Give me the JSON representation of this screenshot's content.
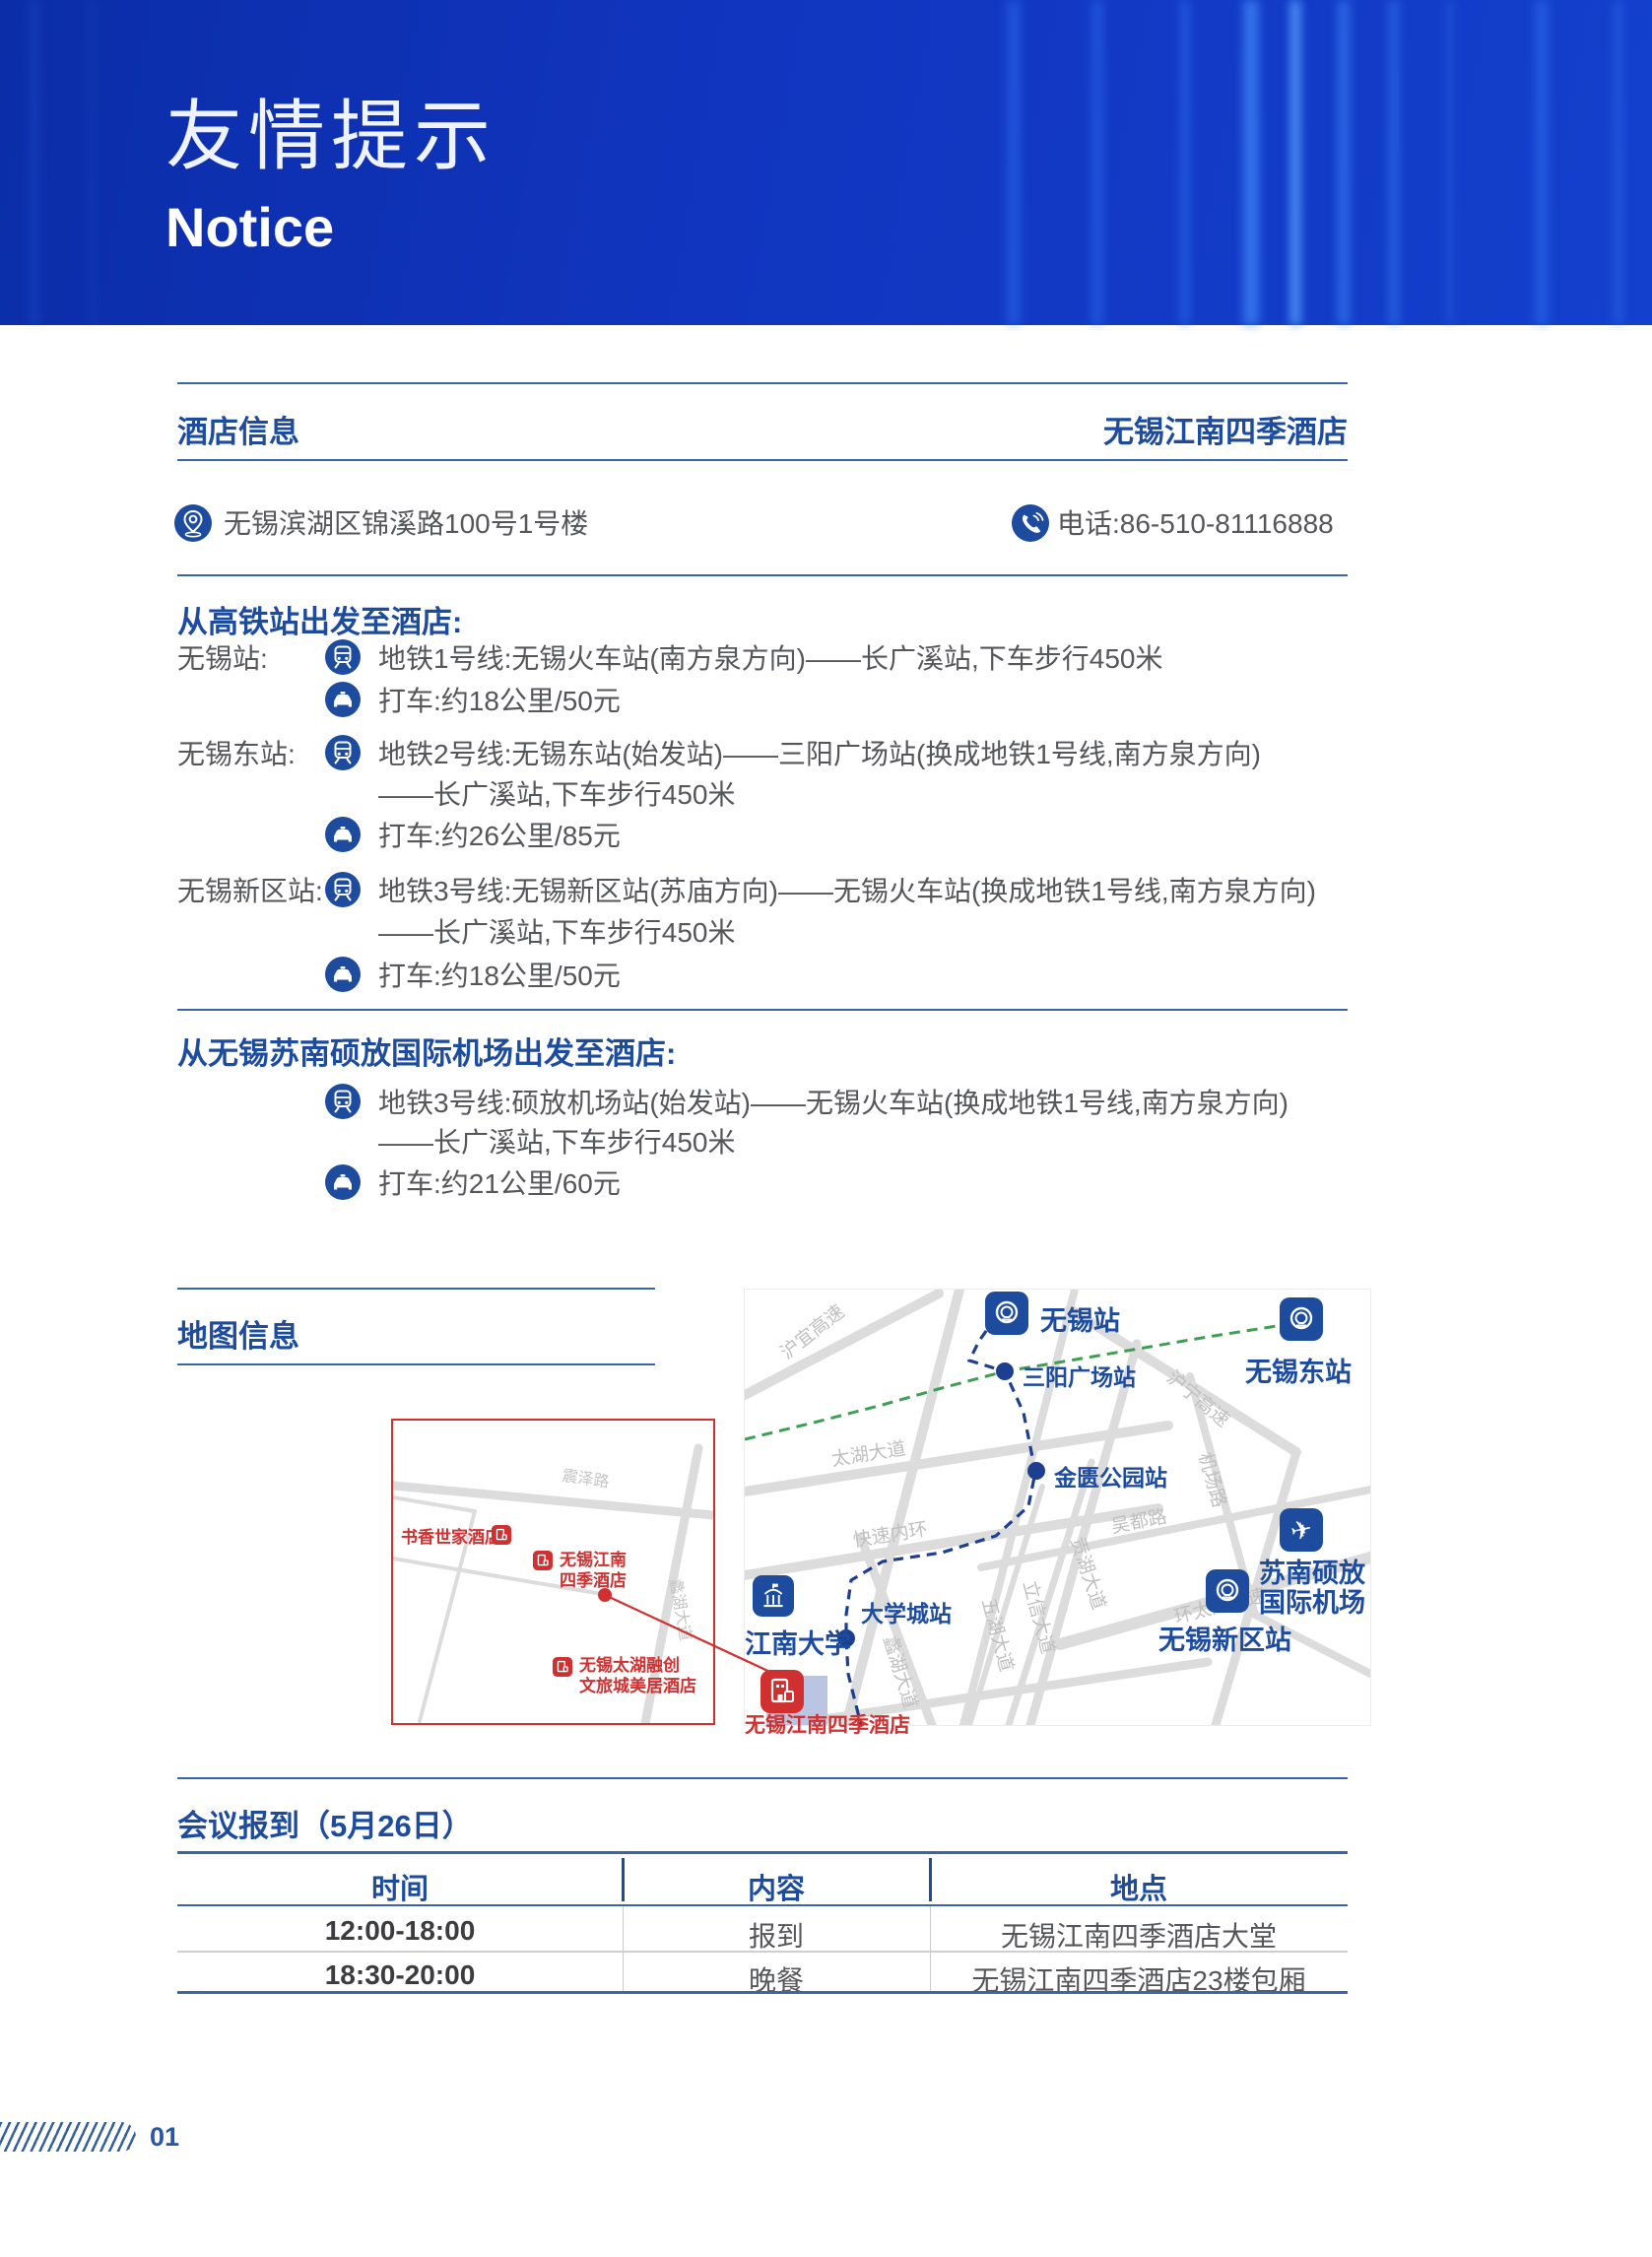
{
  "header": {
    "title_cn": "友情提示",
    "title_en": "Notice"
  },
  "hotel_info": {
    "section_title": "酒店信息",
    "hotel_name": "无锡江南四季酒店",
    "address": "无锡滨湖区锦溪路100号1号楼",
    "phone": "电话:86-510-81116888"
  },
  "rail_section": {
    "title": "从高铁站出发至酒店:",
    "routes": [
      {
        "station": "无锡站:",
        "steps": [
          {
            "text": "地铁1号线:无锡火车站(南方泉方向)——长广溪站,下车步行450米"
          },
          {
            "text": "打车:约18公里/50元"
          }
        ]
      },
      {
        "station": "无锡东站:",
        "steps": [
          {
            "text": "地铁2号线:无锡东站(始发站)——三阳广场站(换成地铁1号线,南方泉方向)"
          },
          {
            "text": "——长广溪站,下车步行450米"
          },
          {
            "text": "打车:约26公里/85元"
          }
        ]
      },
      {
        "station": "无锡新区站:",
        "steps": [
          {
            "text": "地铁3号线:无锡新区站(苏庙方向)——无锡火车站(换成地铁1号线,南方泉方向)"
          },
          {
            "text": "——长广溪站,下车步行450米"
          },
          {
            "text": "打车:约18公里/50元"
          }
        ]
      }
    ]
  },
  "airport_section": {
    "title": "从无锡苏南硕放国际机场出发至酒店:",
    "steps": [
      {
        "text": "地铁3号线:硕放机场站(始发站)——无锡火车站(换成地铁1号线,南方泉方向)"
      },
      {
        "text": "——长广溪站,下车步行450米"
      },
      {
        "text": "打车:约21公里/60元"
      }
    ]
  },
  "map_section": {
    "title": "地图信息",
    "inset": {
      "roads": {
        "zhenze": "震泽路",
        "lihu": "蠡湖大道"
      },
      "poi_shuxiang": "书香世家酒店",
      "poi_hotel_l1": "无锡江南",
      "poi_hotel_l2": "四季酒店",
      "poi_rongchuang_l1": "无锡太湖融创",
      "poi_rongchuang_l2": "文旅城美居酒店"
    },
    "main": {
      "stations": {
        "wuxi": "无锡站",
        "wuxi_east": "无锡东站",
        "sanyang": "三阳广场站",
        "jinkui": "金匮公园站",
        "daxuecheng": "大学城站",
        "xinqu": "无锡新区站"
      },
      "pois": {
        "jiangnan_univ": "江南大学",
        "airport_l1": "苏南硕放",
        "airport_l2": "国际机场",
        "hotel": "无锡江南四季酒店"
      },
      "roads": {
        "huyi": "沪宜高速",
        "taihu": "太湖大道",
        "kuaisu": "快速内环",
        "huning": "沪宁高速",
        "jichang": "机场路",
        "gonghu": "贡湖大道",
        "wudu": "吴都路",
        "wuhu": "五湖大道",
        "lixin": "立信大道",
        "lihu": "蠡湖大道",
        "huantaihu": "环太湖高速"
      }
    }
  },
  "meeting": {
    "title": "会议报到（5月26日）",
    "headers": [
      "时间",
      "内容",
      "地点"
    ],
    "rows": [
      [
        "12:00-18:00",
        "报到",
        "无锡江南四季酒店大堂"
      ],
      [
        "18:30-20:00",
        "晚餐",
        "无锡江南四季酒店23楼包厢"
      ]
    ]
  },
  "footer": {
    "page_number": "01"
  },
  "colors": {
    "accent_blue": "#1d4b9e",
    "line_blue": "#3a66a8",
    "banner_blue": "#1135bf",
    "poi_red": "#d03030",
    "route_green": "#3f9e53",
    "route_navy": "#1e3f8f"
  }
}
